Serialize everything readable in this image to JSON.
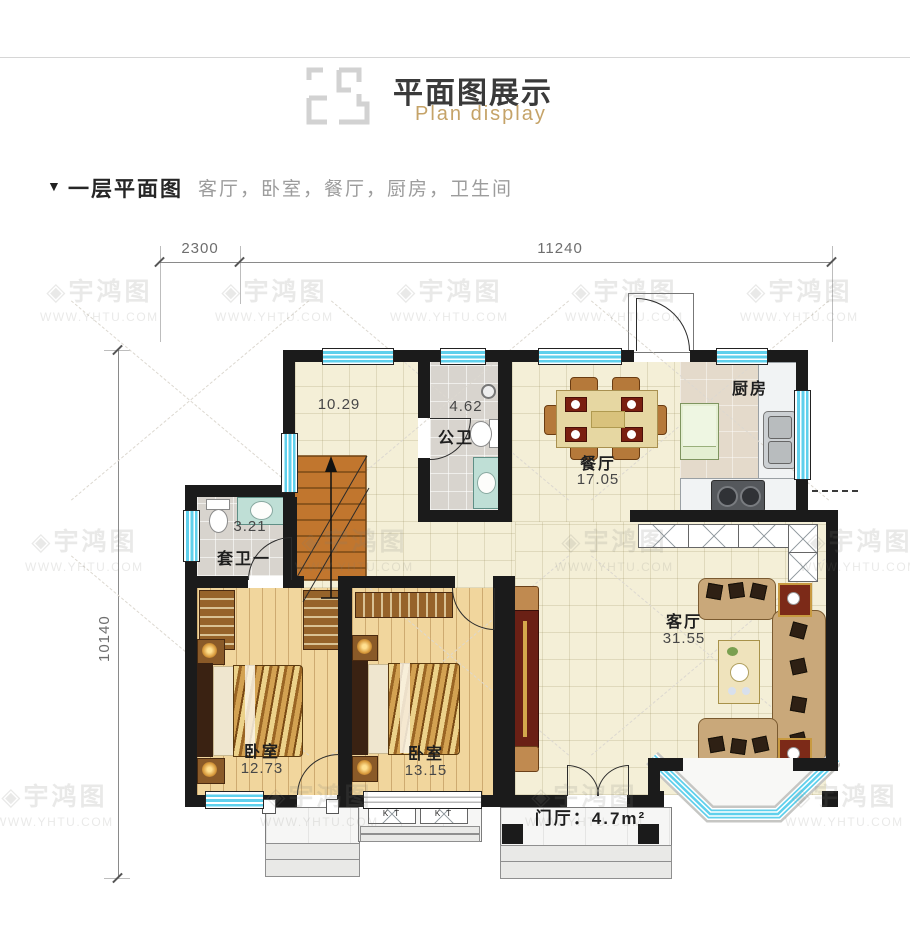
{
  "header": {
    "title": "平面图展示",
    "subtitle": "Plan display"
  },
  "section": {
    "marker": "▼",
    "title": "一层平面图",
    "rooms_list": "客厅，卧室，餐厅，厨房，卫生间"
  },
  "dimensions": {
    "top_left": "2300",
    "top_main": "11240",
    "left_side": "10140"
  },
  "rooms": {
    "stair_hall": {
      "area": "10.29"
    },
    "public_bath": {
      "label": "公卫",
      "area": "4.62"
    },
    "dining": {
      "label": "餐厅",
      "area": "17.05"
    },
    "kitchen": {
      "label": "厨房"
    },
    "ensuite_bath": {
      "label": "套卫一",
      "area": "3.21"
    },
    "bedroom_1": {
      "label": "卧室",
      "area": "12.73"
    },
    "bedroom_2": {
      "label": "卧室",
      "area": "13.15"
    },
    "living": {
      "label": "客厅",
      "area": "31.55"
    },
    "foyer": {
      "label": "门厅：4.7m²"
    }
  },
  "equipment": {
    "ac_label": "K T"
  },
  "watermark": {
    "brand": "宇鸿图",
    "icon": "◈",
    "url": "WWW.YHTU.COM"
  },
  "colors": {
    "wall": "#1b1b1b",
    "window_cyan": "#5fd0ec",
    "accent_gold": "#c5a368",
    "floor_cream": "#f4efd7",
    "floor_wood": "#f1d69d",
    "tile_gray": "#d8d4ce"
  }
}
